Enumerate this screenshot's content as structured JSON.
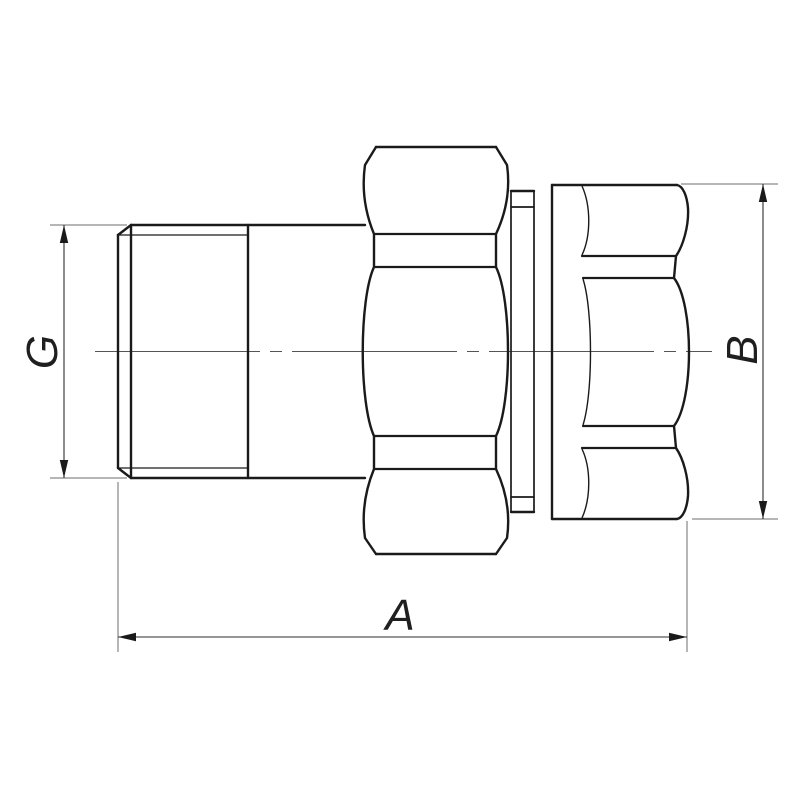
{
  "drawing": {
    "kind": "pipe-union-fitting-side-view",
    "dimension_labels": {
      "thread_diameter": "G",
      "overall_length": "A",
      "body_hex_size": "B"
    },
    "colors": {
      "background": "#ffffff",
      "outline": "#1a1a1a",
      "dimension_line": "#2e2e2e",
      "extension_line": "#6e6e6e",
      "centerline": "#555555",
      "label_text": "#1f1f1f"
    }
  }
}
